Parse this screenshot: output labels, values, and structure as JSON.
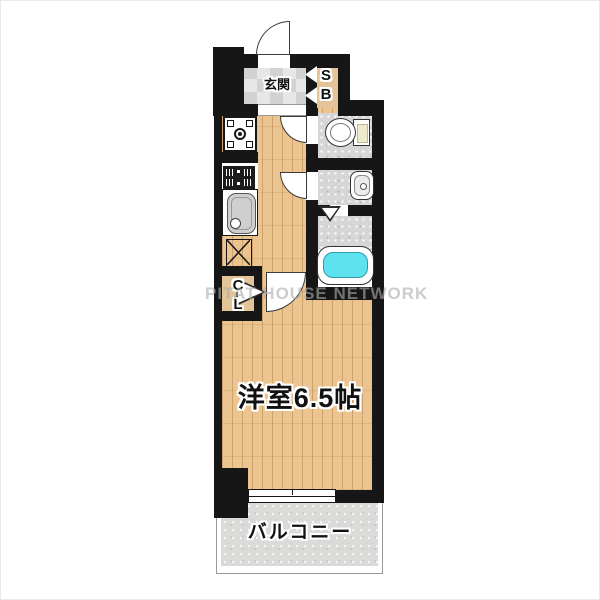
{
  "watermark": "PITAT HOUSE NETWORK",
  "rooms": {
    "entrance_label": "玄関",
    "shoebox": {
      "l1": "S",
      "l2": "B"
    },
    "closet": {
      "l1": "C",
      "l2": "L"
    },
    "main_room_label": "洋室6.5帖",
    "balcony_label": "バルコニー"
  },
  "colors": {
    "wall": "#161616",
    "wood_floor": "#ebc48f",
    "entrance_tile": "#d9d9d9",
    "storage_tan": "#e3c398",
    "wet_area_grey": "#d6d6d6",
    "bathtub_water": "#5fe2f0",
    "balcony_grey": "#dadad8",
    "watermark_grey": "#acacac"
  }
}
